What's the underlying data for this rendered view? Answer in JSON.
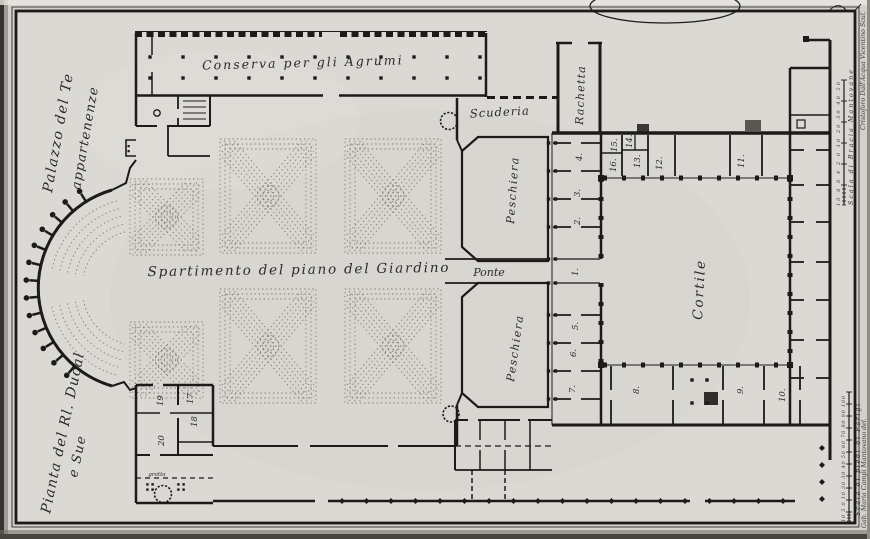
{
  "plate": {
    "border_titles": {
      "palazzo": "Palazzo del Te",
      "appartenenze": "appartenenze",
      "pianta": "Pianta del Rl. Ducal",
      "e_sue": "e Sue"
    },
    "labels": {
      "conserva": "Conserva per gli Agrumi",
      "scuderia": "Scuderia",
      "rachetta": "Rachetta",
      "peschiera_upper": "Peschiera",
      "peschiera_lower": "Peschiera",
      "ponte": "Ponte",
      "cortile": "Cortile",
      "giardino": "Spartimento del piano del Giardino",
      "grotta": "grotta"
    },
    "rooms": {
      "n1": "1.",
      "n2": "2.",
      "n3": "3.",
      "n4": "4.",
      "n5": "5.",
      "n6": "6.",
      "n7": "7.",
      "n8": "8.",
      "n9": "9.",
      "n10": "10.",
      "n11": "11.",
      "n12": "12.",
      "n13": "13.",
      "n14": "14.",
      "n15": "15.",
      "n16": "16.",
      "n17": "17",
      "n18": "18",
      "n19": "19",
      "n20": "20"
    },
    "scales": {
      "braccia": {
        "ticks": "10 8 6 4 2 0   10    20    30    40    50",
        "label": "Scala di Bracia Mantovane"
      },
      "parigi": {
        "ticks": "10 5 0  10  20  30  40  50  60  70  80  90 100",
        "label": "Scala di piedi di Parigi"
      }
    },
    "credits": {
      "engraver": "Cristoforo Dall'Acqua Vicentino Scul.",
      "draughtsman": "Gab. Maria Campi Mantovano del."
    },
    "colors": {
      "ink": "#1c1b19",
      "paper": "#d9d7d1",
      "parterre": "#7f7d76"
    }
  }
}
